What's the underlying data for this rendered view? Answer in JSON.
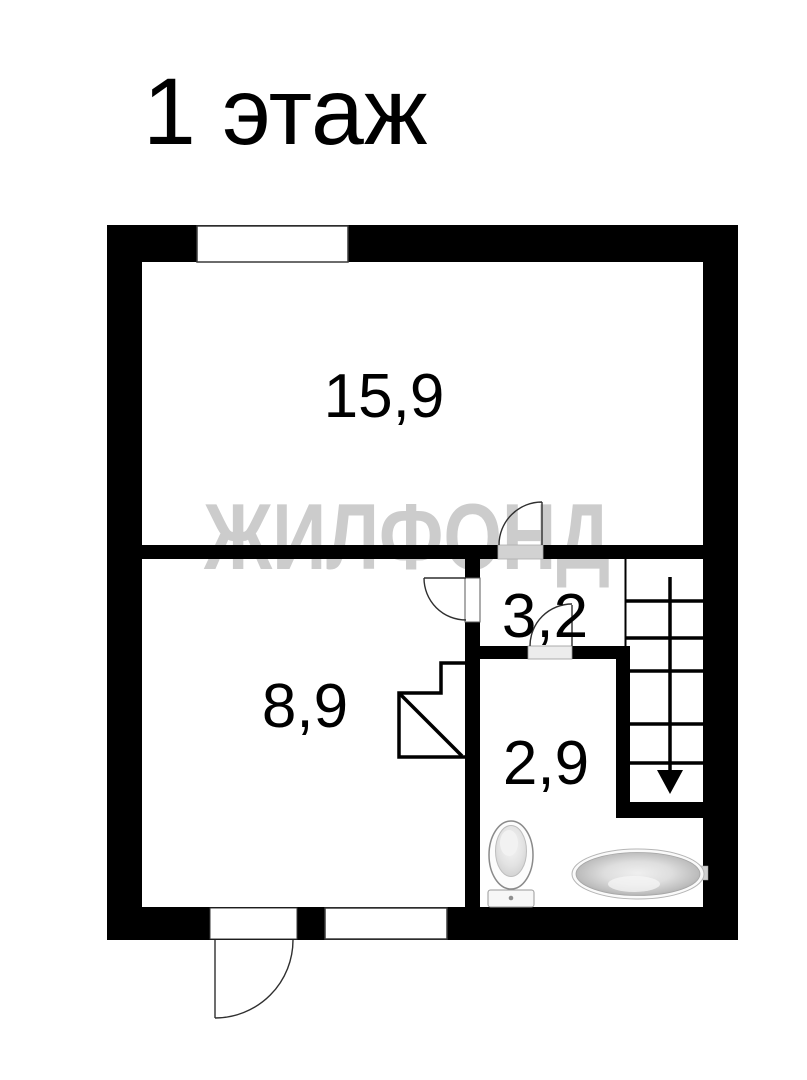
{
  "page": {
    "background": "#ffffff",
    "title": "1 этаж"
  },
  "watermark": {
    "text": "ЖИЛФОНД",
    "color": "#cccccc"
  },
  "floor_plan": {
    "rooms": [
      {
        "id": "room-15-9",
        "area_label": "15,9"
      },
      {
        "id": "room-8-9",
        "area_label": "8,9"
      },
      {
        "id": "hall-3-2",
        "area_label": "3,2"
      },
      {
        "id": "bath-2-9",
        "area_label": "2,9"
      }
    ],
    "icons": [
      "toilet-icon",
      "bathtub-icon",
      "stairs-icon",
      "stairs-down-arrow-icon",
      "door-swing-icon",
      "window-icon",
      "understairs-closet-icon"
    ],
    "colors": {
      "wall": "#000000",
      "door_opening_shaded": "#d2d2d2",
      "door_opening_light": "#ececec",
      "fixture_outline": "#9a9a9a",
      "room_hairline": "#8a8a8a"
    }
  }
}
